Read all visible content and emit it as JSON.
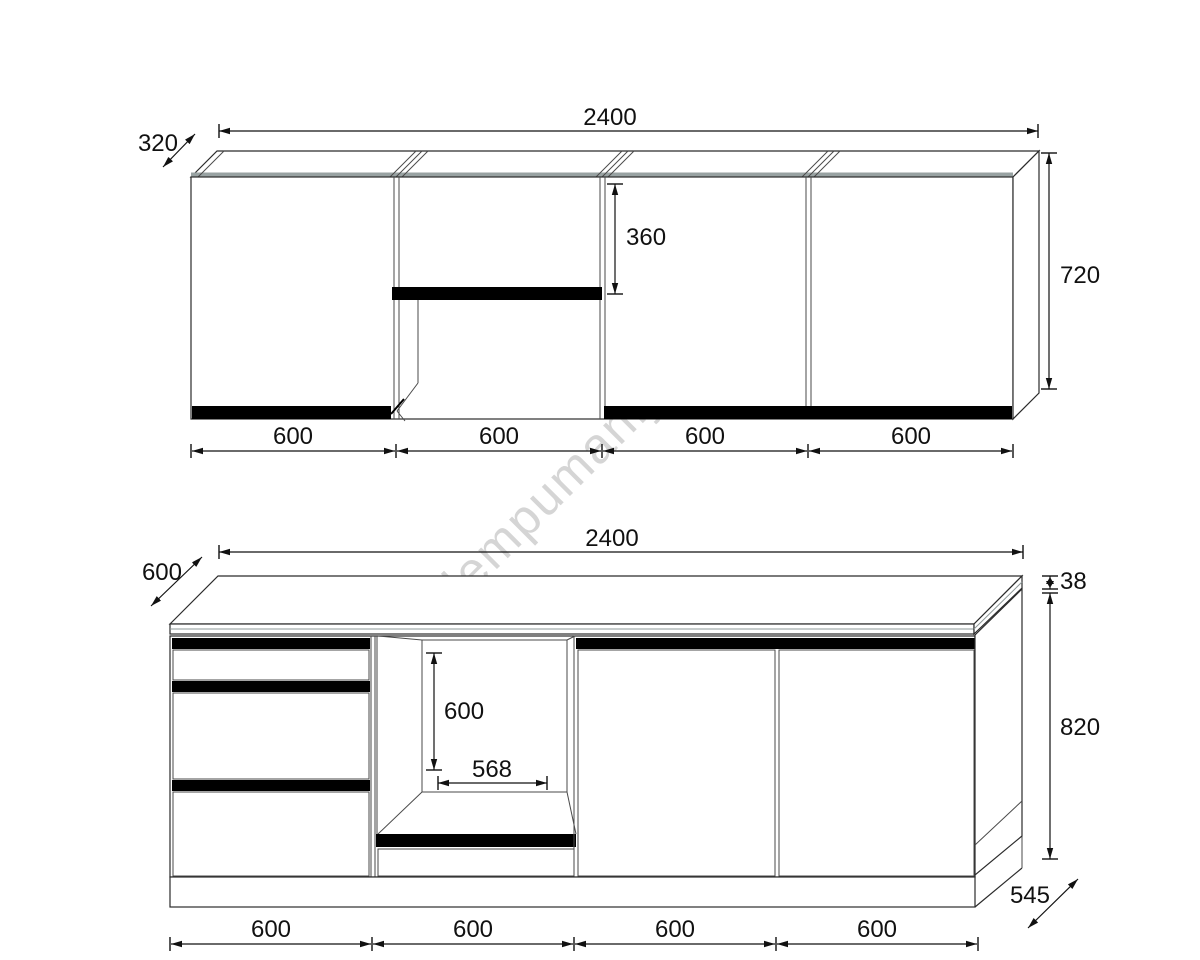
{
  "drawing": {
    "watermark_text": "lempumanija.lt",
    "top_view": {
      "total_width": "2400",
      "depth": "320",
      "height": "720",
      "niche_flap_height": "360",
      "section_widths": [
        "600",
        "600",
        "600",
        "600"
      ]
    },
    "bottom_view": {
      "total_width": "2400",
      "worktop_depth": "600",
      "worktop_thickness": "38",
      "carcass_height": "820",
      "carcass_depth": "545",
      "oven_niche_height": "600",
      "oven_niche_width": "568",
      "section_widths": [
        "600",
        "600",
        "600",
        "600"
      ]
    },
    "colors": {
      "line": "#2b2b2b",
      "panel_edge_band": "#98a2a2",
      "front_strip": "#000000",
      "watermark": "#d5d5d5",
      "background": "#ffffff"
    }
  }
}
